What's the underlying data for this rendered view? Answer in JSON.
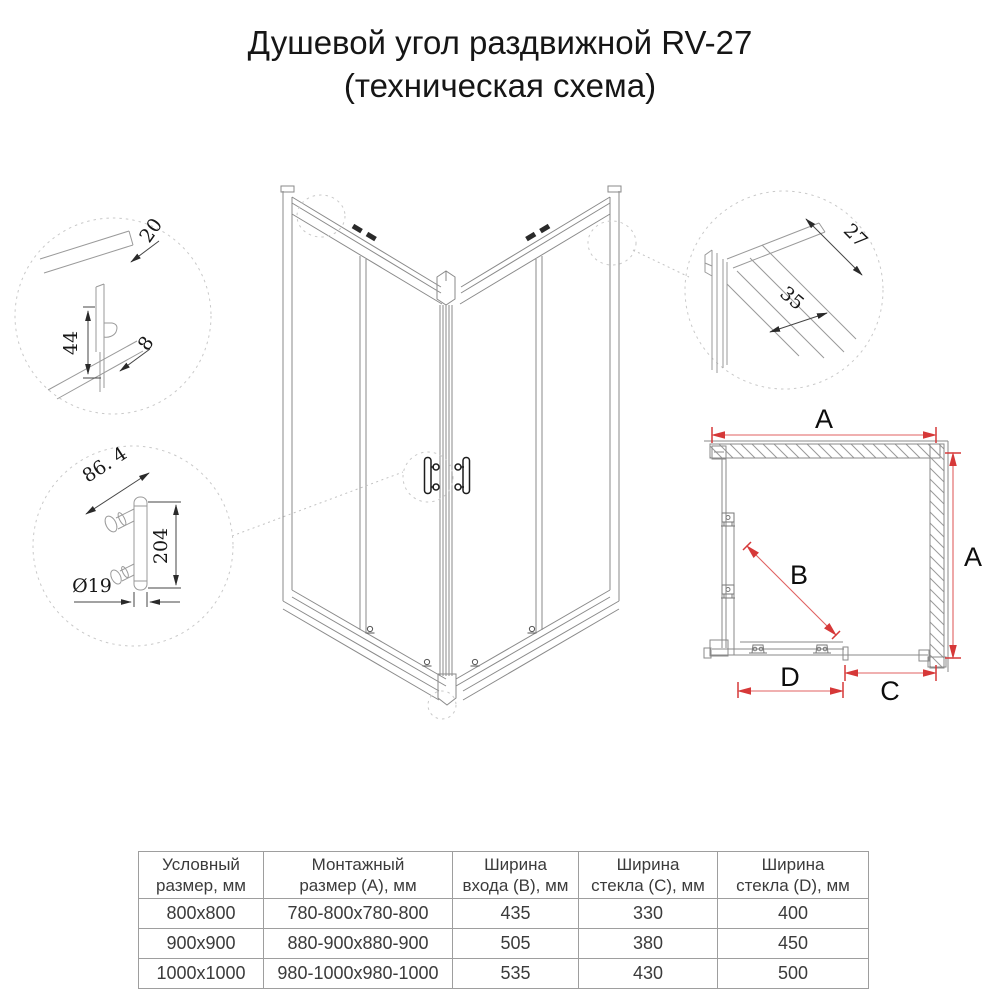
{
  "title": {
    "line1": "Душевой угол раздвижной RV-27",
    "line2": "(техническая схема)"
  },
  "details": {
    "top_profile": {
      "depth": "20",
      "height": "44",
      "gap": "8"
    },
    "handle": {
      "offset": "86. 4",
      "length": "204",
      "diameter": "Ø19"
    },
    "wall_profile": {
      "depth": "27",
      "width": "35"
    }
  },
  "plan": {
    "width_top": "A",
    "height_right": "A",
    "entry_diagonal": "B",
    "glass_right": "C",
    "glass_bottom": "D"
  },
  "table": {
    "headers": [
      {
        "l1": "Условный",
        "l2": "размер, мм"
      },
      {
        "l1": "Монтажный",
        "l2": "размер (A), мм"
      },
      {
        "l1": "Ширина",
        "l2": "входа (B), мм"
      },
      {
        "l1": "Ширина",
        "l2": "стекла (C), мм"
      },
      {
        "l1": "Ширина",
        "l2": "стекла (D), мм"
      }
    ],
    "rows": [
      [
        "800x800",
        "780-800x780-800",
        "435",
        "330",
        "400"
      ],
      [
        "900x900",
        "880-900x880-900",
        "505",
        "380",
        "450"
      ],
      [
        "1000x1000",
        "980-1000x980-1000",
        "535",
        "430",
        "500"
      ]
    ]
  },
  "colors": {
    "dimension_red": "#d63838",
    "line_gray": "#8a8a8a"
  }
}
